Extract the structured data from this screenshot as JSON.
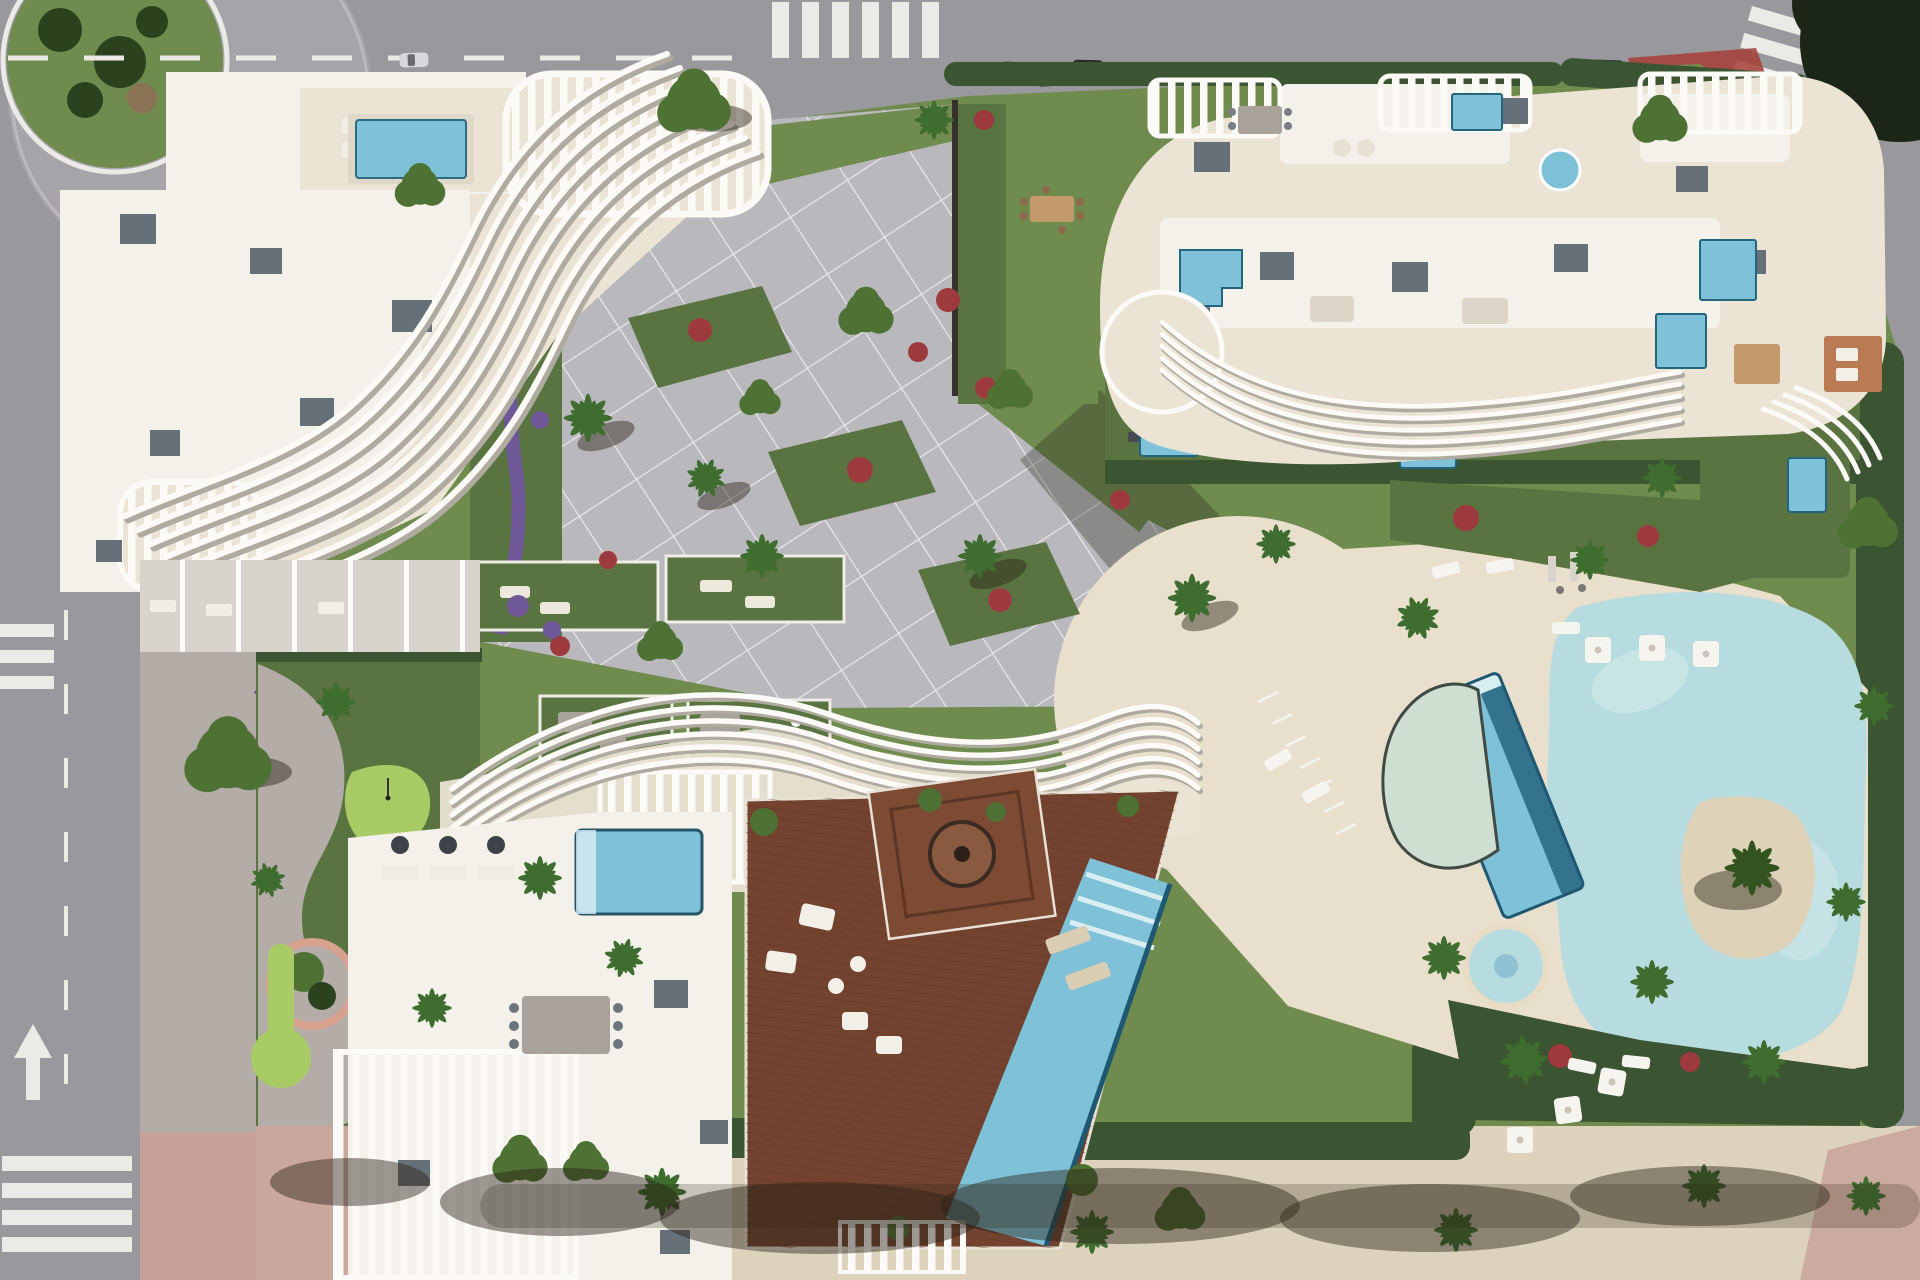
{
  "scene": {
    "type": "aerial-architectural-render",
    "buildings": [
      "left-residential-building",
      "north-east-residential-building",
      "south-residential-building"
    ],
    "amenities": [
      "lagoon-pool",
      "lap-pool",
      "half-moon-pool",
      "kids-pool",
      "beach-deck",
      "mini-golf",
      "rooftop-plunge-pools",
      "wooden-roof-deck",
      "deck-infinity-pool",
      "pergola-trellis",
      "garden-patios"
    ],
    "context": [
      "roundabout",
      "top-road",
      "left-road",
      "promenade",
      "crosswalks",
      "parked-cars",
      "red-bus-shelter",
      "hedges",
      "palm-trees"
    ]
  },
  "palette": {
    "asphalt": "#99989c",
    "asphalt_light": "#a6a4a8",
    "road_marking": "#eceae6",
    "sidewalk": "#b4aca7",
    "sidewalk_pink": "#c7a097",
    "promenade_sand": "#ddd2bc",
    "lawn": "#6f8b4d",
    "lawn_dark": "#5a7441",
    "lawn_bright": "#a9cb66",
    "hedge": "#3b5431",
    "hedge_dark": "#2c421f",
    "flower_red": "#9d3a3e",
    "flower_purple": "#6f5898",
    "paver": "#b9b8bc",
    "paver_line": "#ebebee",
    "pool_deck": "#e8dfcc",
    "water_light": "#b7dce0",
    "water_pale": "#cedfd2",
    "water_mid": "#7fc2d8",
    "water_deep": "#27657f",
    "water_rim": "#1f5872",
    "water_step": "#d9eef2",
    "sand_island": "#ded3b8",
    "wood_deck": "#74432f",
    "wood_dark": "#5a3423",
    "roof_white": "#f3f1ea",
    "terrace_beige": "#ebe3d3",
    "fin_white": "#fbfaf6",
    "fin_shadow": "#b0aba1",
    "roof_box": "#667078",
    "shadow": "rgba(40,40,32,0.32)",
    "shade_tree": "rgba(42,36,24,0.45)",
    "tree_green": "#4e7234",
    "tree_dark": "#33531f",
    "palm_green": "#3f6c2f",
    "car_dark": "#2b2c31",
    "car_light": "#d8d7d9",
    "red_accent": "#a43d35",
    "rug": "#b97a54",
    "teal": "#2fa7a0",
    "umbrella": "#f6f4ee",
    "table_wood": "#c49a6c",
    "furn_gray": "#a8a29a"
  }
}
